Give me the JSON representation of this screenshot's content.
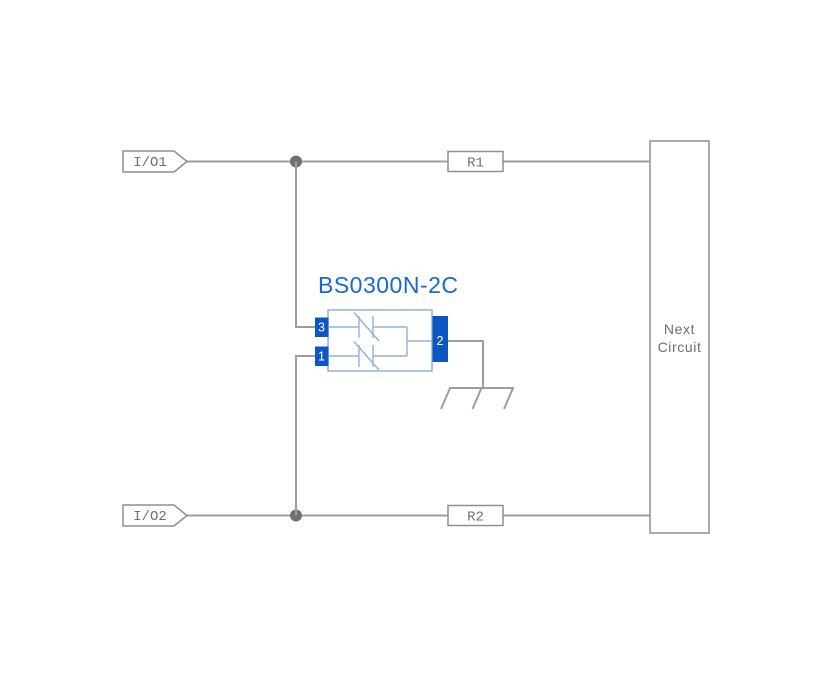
{
  "diagram": {
    "component": {
      "name": "BS0300N-2C",
      "pins": [
        {
          "number": "3",
          "side": "top-left"
        },
        {
          "number": "1",
          "side": "bottom-left"
        },
        {
          "number": "2",
          "side": "right"
        }
      ]
    },
    "connectors": [
      {
        "label": "I/O1"
      },
      {
        "label": "I/O2"
      }
    ],
    "resistors": [
      {
        "label": "R1"
      },
      {
        "label": "R2"
      }
    ],
    "next_circuit": {
      "line1": "Next",
      "line2": "Circuit"
    }
  },
  "colors": {
    "wire": "#9d9d9d",
    "outline": "#8f8f8f",
    "text_gray": "#6f6f6f",
    "junction": "#6f6f6f",
    "pin_blue": "#0e56c3",
    "title_blue": "#1668d9",
    "component_blue": "#8fb2de",
    "background": "#ffffff"
  }
}
